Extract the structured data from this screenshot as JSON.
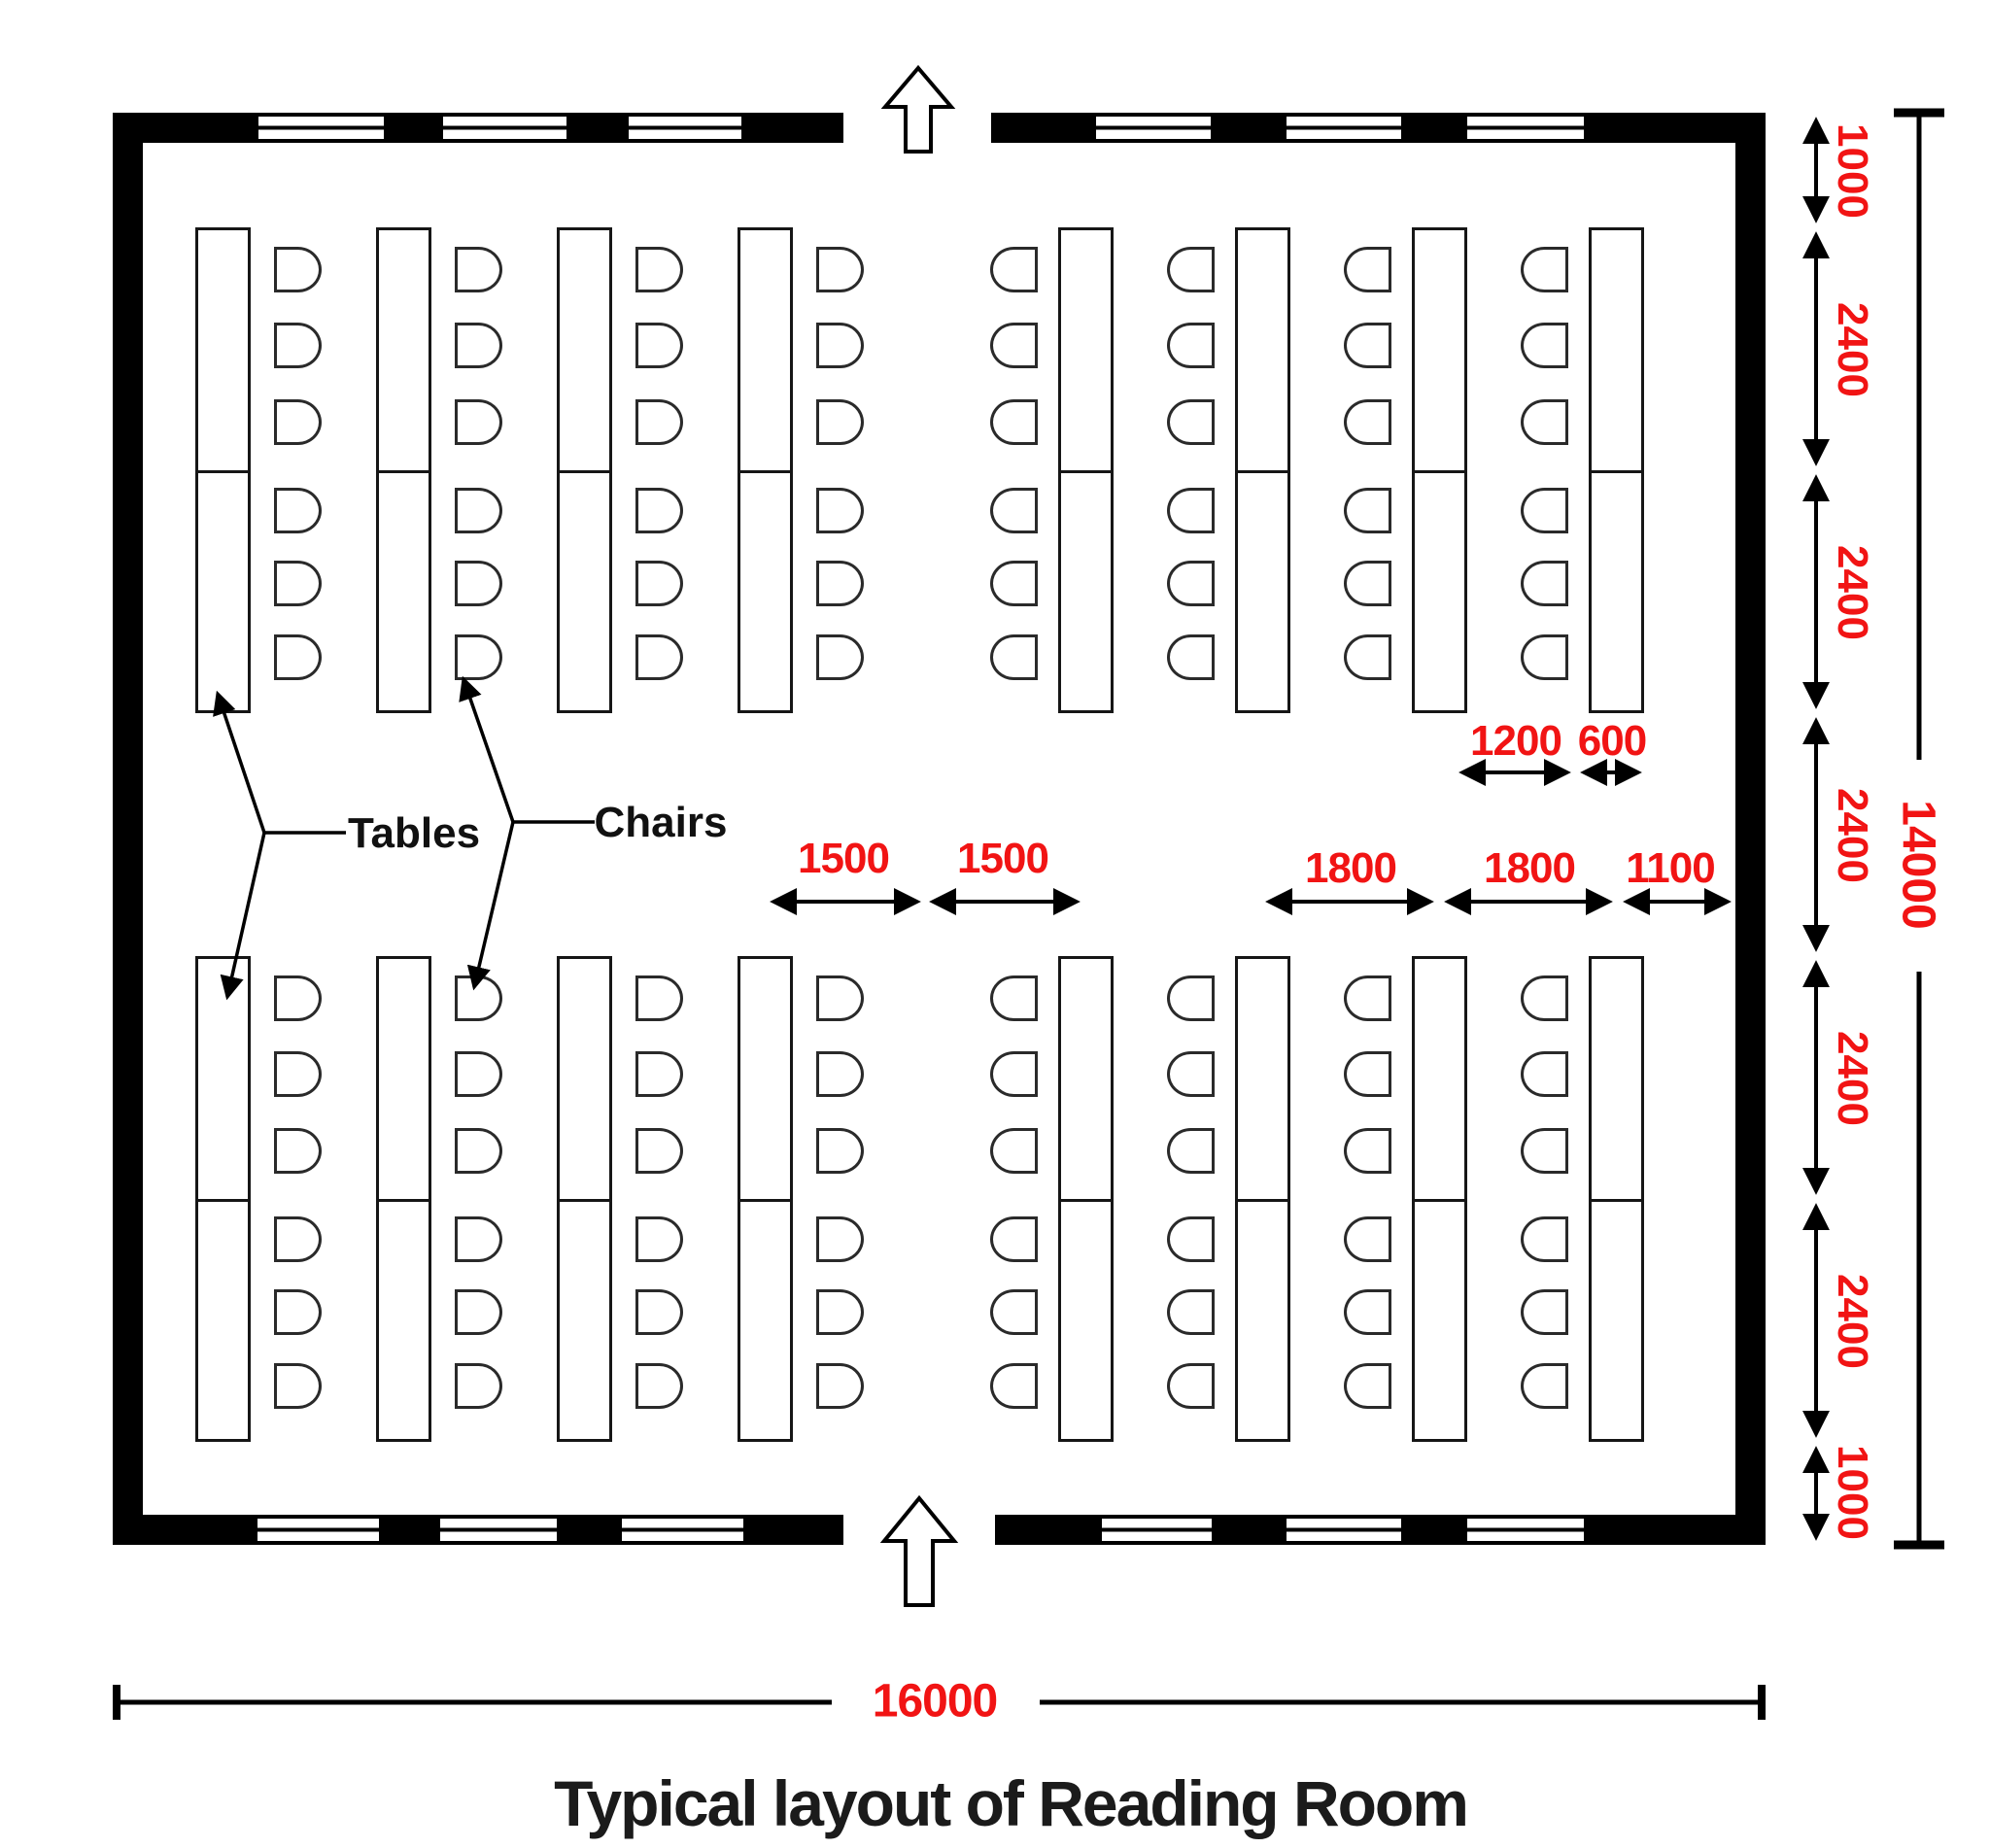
{
  "title": "Typical layout of Reading Room",
  "labels": {
    "tables": "Tables",
    "chairs": "Chairs"
  },
  "dimensions": {
    "overall_width": "16000",
    "overall_height": "14000",
    "vertical_chain": [
      "1000",
      "2400",
      "2400",
      "2400",
      "2400",
      "2400",
      "1000"
    ],
    "center_aisle": [
      "1500",
      "1500"
    ],
    "right_bay": [
      "1800",
      "1800",
      "1100"
    ],
    "table_unit": [
      "1200",
      "600"
    ]
  },
  "colors": {
    "dimension_red": "#f11414",
    "ink": "#000000",
    "title": "#1b1b1b"
  },
  "icons": {
    "door": "up-arrow",
    "window": "triple-line-window-symbol"
  },
  "layout_counts": {
    "table_columns": 16,
    "tables_per_column": 2,
    "chairs_per_table": 3,
    "total_chairs": 96,
    "windows_top_wall": 6,
    "windows_bottom_wall": 6,
    "door_openings": 2
  }
}
